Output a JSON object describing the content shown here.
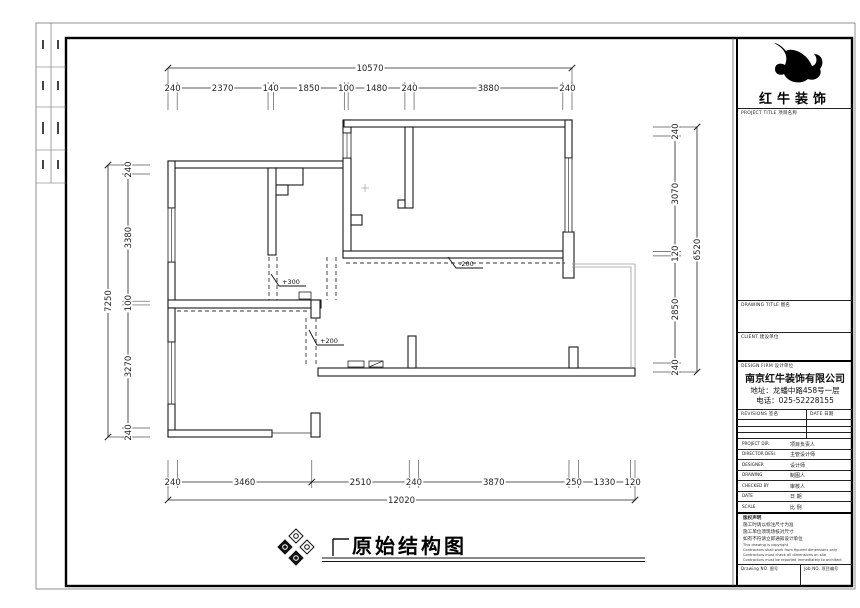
{
  "sheet": {
    "bottom_title": "原始结构图"
  },
  "brand": {
    "name": "红牛装饰",
    "project_title_label": "PROJECT TITLE 项目名称"
  },
  "title_block": {
    "drawing_title_label": "DRAWING TITLE 图名",
    "client_label": "CLIENT 建设单位",
    "design_firm_label": "DESIGN FIRM 设计单位",
    "company_name": "南京红牛装饰有限公司",
    "company_address": "地址：龙蟠中路458号一层",
    "company_phone": "电话：025-52228155",
    "revisions_label": "REVISIONS 签名",
    "revisions_date_label": "DATE 日期",
    "info_rows": [
      {
        "en": "PROJECT DIR.",
        "zh": "项目负责人"
      },
      {
        "en": "DIRECTOR DESI.",
        "zh": "主管设计师"
      },
      {
        "en": "DESIGNER",
        "zh": "设计师"
      },
      {
        "en": "DRAWING",
        "zh": "制图人"
      },
      {
        "en": "CHECKED BY",
        "zh": "审核人"
      },
      {
        "en": "DATE",
        "zh": "日 期"
      },
      {
        "en": "SCALE",
        "zh": "比 例"
      }
    ],
    "notes_title": "版权声明",
    "notes_zh": [
      "施工时请以标注尺寸为准",
      "施工单位须现场核对尺寸",
      "如有不符请立即通知设计单位"
    ],
    "notes_en": [
      "This drawing is copyright",
      "Contractors shall work from figured dimensions only",
      "Contractors must check all dimensions on site",
      "Contractors must be reported immediately to architect"
    ],
    "drawing_no_label": "Drawing NO. 图号",
    "job_no_label": "Job NO. 项目编号"
  },
  "dimensions": {
    "top": {
      "total": "10570",
      "segments": [
        240,
        2370,
        140,
        1850,
        100,
        1480,
        240,
        3880,
        240
      ]
    },
    "bottom": {
      "total": "12020",
      "segments": [
        240,
        3460,
        2510,
        240,
        3870,
        250,
        1330,
        120
      ]
    },
    "left": {
      "total": "7250",
      "segments": [
        240,
        3380,
        100,
        3270,
        240
      ]
    },
    "right": {
      "total": "6520",
      "segments": [
        240,
        3070,
        120,
        2850,
        240
      ]
    }
  },
  "annotations": {
    "a1": "+300",
    "a2": "+200",
    "a3": "-200"
  }
}
